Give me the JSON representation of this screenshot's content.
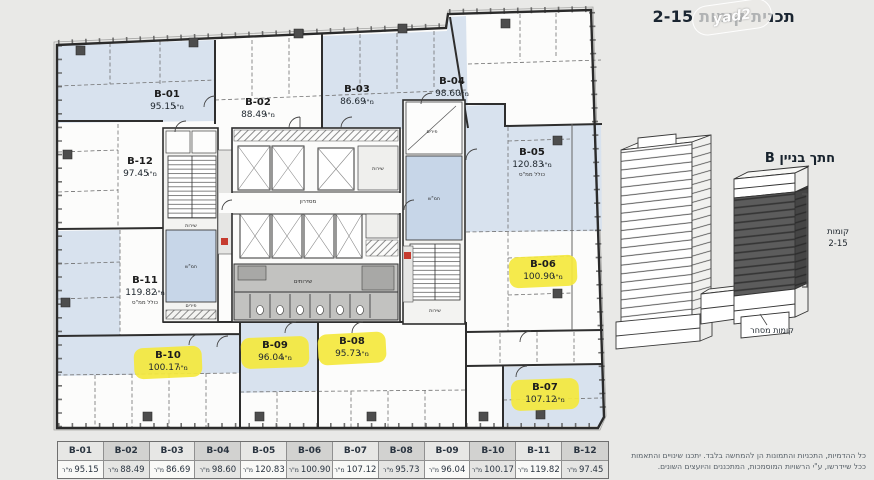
{
  "title": "תכנית קומות 2-15",
  "watermark": "yad2",
  "labels": {
    "sqm": "מ\"ר"
  },
  "plan": {
    "units": [
      {
        "id": "B-01",
        "area": "95.15",
        "extra": "",
        "highlight": false
      },
      {
        "id": "B-02",
        "area": "88.49",
        "extra": "",
        "highlight": false
      },
      {
        "id": "B-03",
        "area": "86.69",
        "extra": "",
        "highlight": false
      },
      {
        "id": "B-04",
        "area": "98.60",
        "extra": "",
        "highlight": false
      },
      {
        "id": "B-05",
        "area": "120.83",
        "extra": "כולל ממ\"ס",
        "highlight": false
      },
      {
        "id": "B-06",
        "area": "100.90",
        "extra": "",
        "highlight": true
      },
      {
        "id": "B-07",
        "area": "107.12",
        "extra": "",
        "highlight": true
      },
      {
        "id": "B-08",
        "area": "95.73",
        "extra": "",
        "highlight": true
      },
      {
        "id": "B-09",
        "area": "96.04",
        "extra": "",
        "highlight": true
      },
      {
        "id": "B-10",
        "area": "100.17",
        "extra": "",
        "highlight": true
      },
      {
        "id": "B-11",
        "area": "119.82",
        "extra": "כולל ממ\"ס",
        "highlight": false
      },
      {
        "id": "B-12",
        "area": "97.45",
        "extra": "",
        "highlight": false
      }
    ],
    "rooms": {
      "corridor": "מסדרון",
      "toilets": "שירותים",
      "service": "שירות",
      "shafts": "פירים",
      "shelter": "חמ\"ש"
    }
  },
  "section": {
    "title": "חתך בניין B",
    "floors_line1": "קומות",
    "floors_line2": "2-15",
    "commerce": "קומות מסחר"
  },
  "table": {
    "rows": [
      {
        "name": "B-01",
        "area": "95.15"
      },
      {
        "name": "B-02",
        "area": "88.49"
      },
      {
        "name": "B-03",
        "area": "86.69"
      },
      {
        "name": "B-04",
        "area": "98.60"
      },
      {
        "name": "B-05",
        "area": "120.83"
      },
      {
        "name": "B-06",
        "area": "100.90"
      },
      {
        "name": "B-07",
        "area": "107.12"
      },
      {
        "name": "B-08",
        "area": "95.73"
      },
      {
        "name": "B-09",
        "area": "96.04"
      },
      {
        "name": "B-10",
        "area": "100.17"
      },
      {
        "name": "B-11",
        "area": "119.82"
      },
      {
        "name": "B-12",
        "area": "97.45"
      }
    ]
  },
  "disclaimer": {
    "line1": "כל ההדמיות, התכניות והתמונות הן להמחשה בלבד. יתכנו שינויים והתאמות",
    "line2": "ככל שיידרשו, ע\"י הרשויות המוסמכות, המתכננים והיועצים השונים."
  }
}
